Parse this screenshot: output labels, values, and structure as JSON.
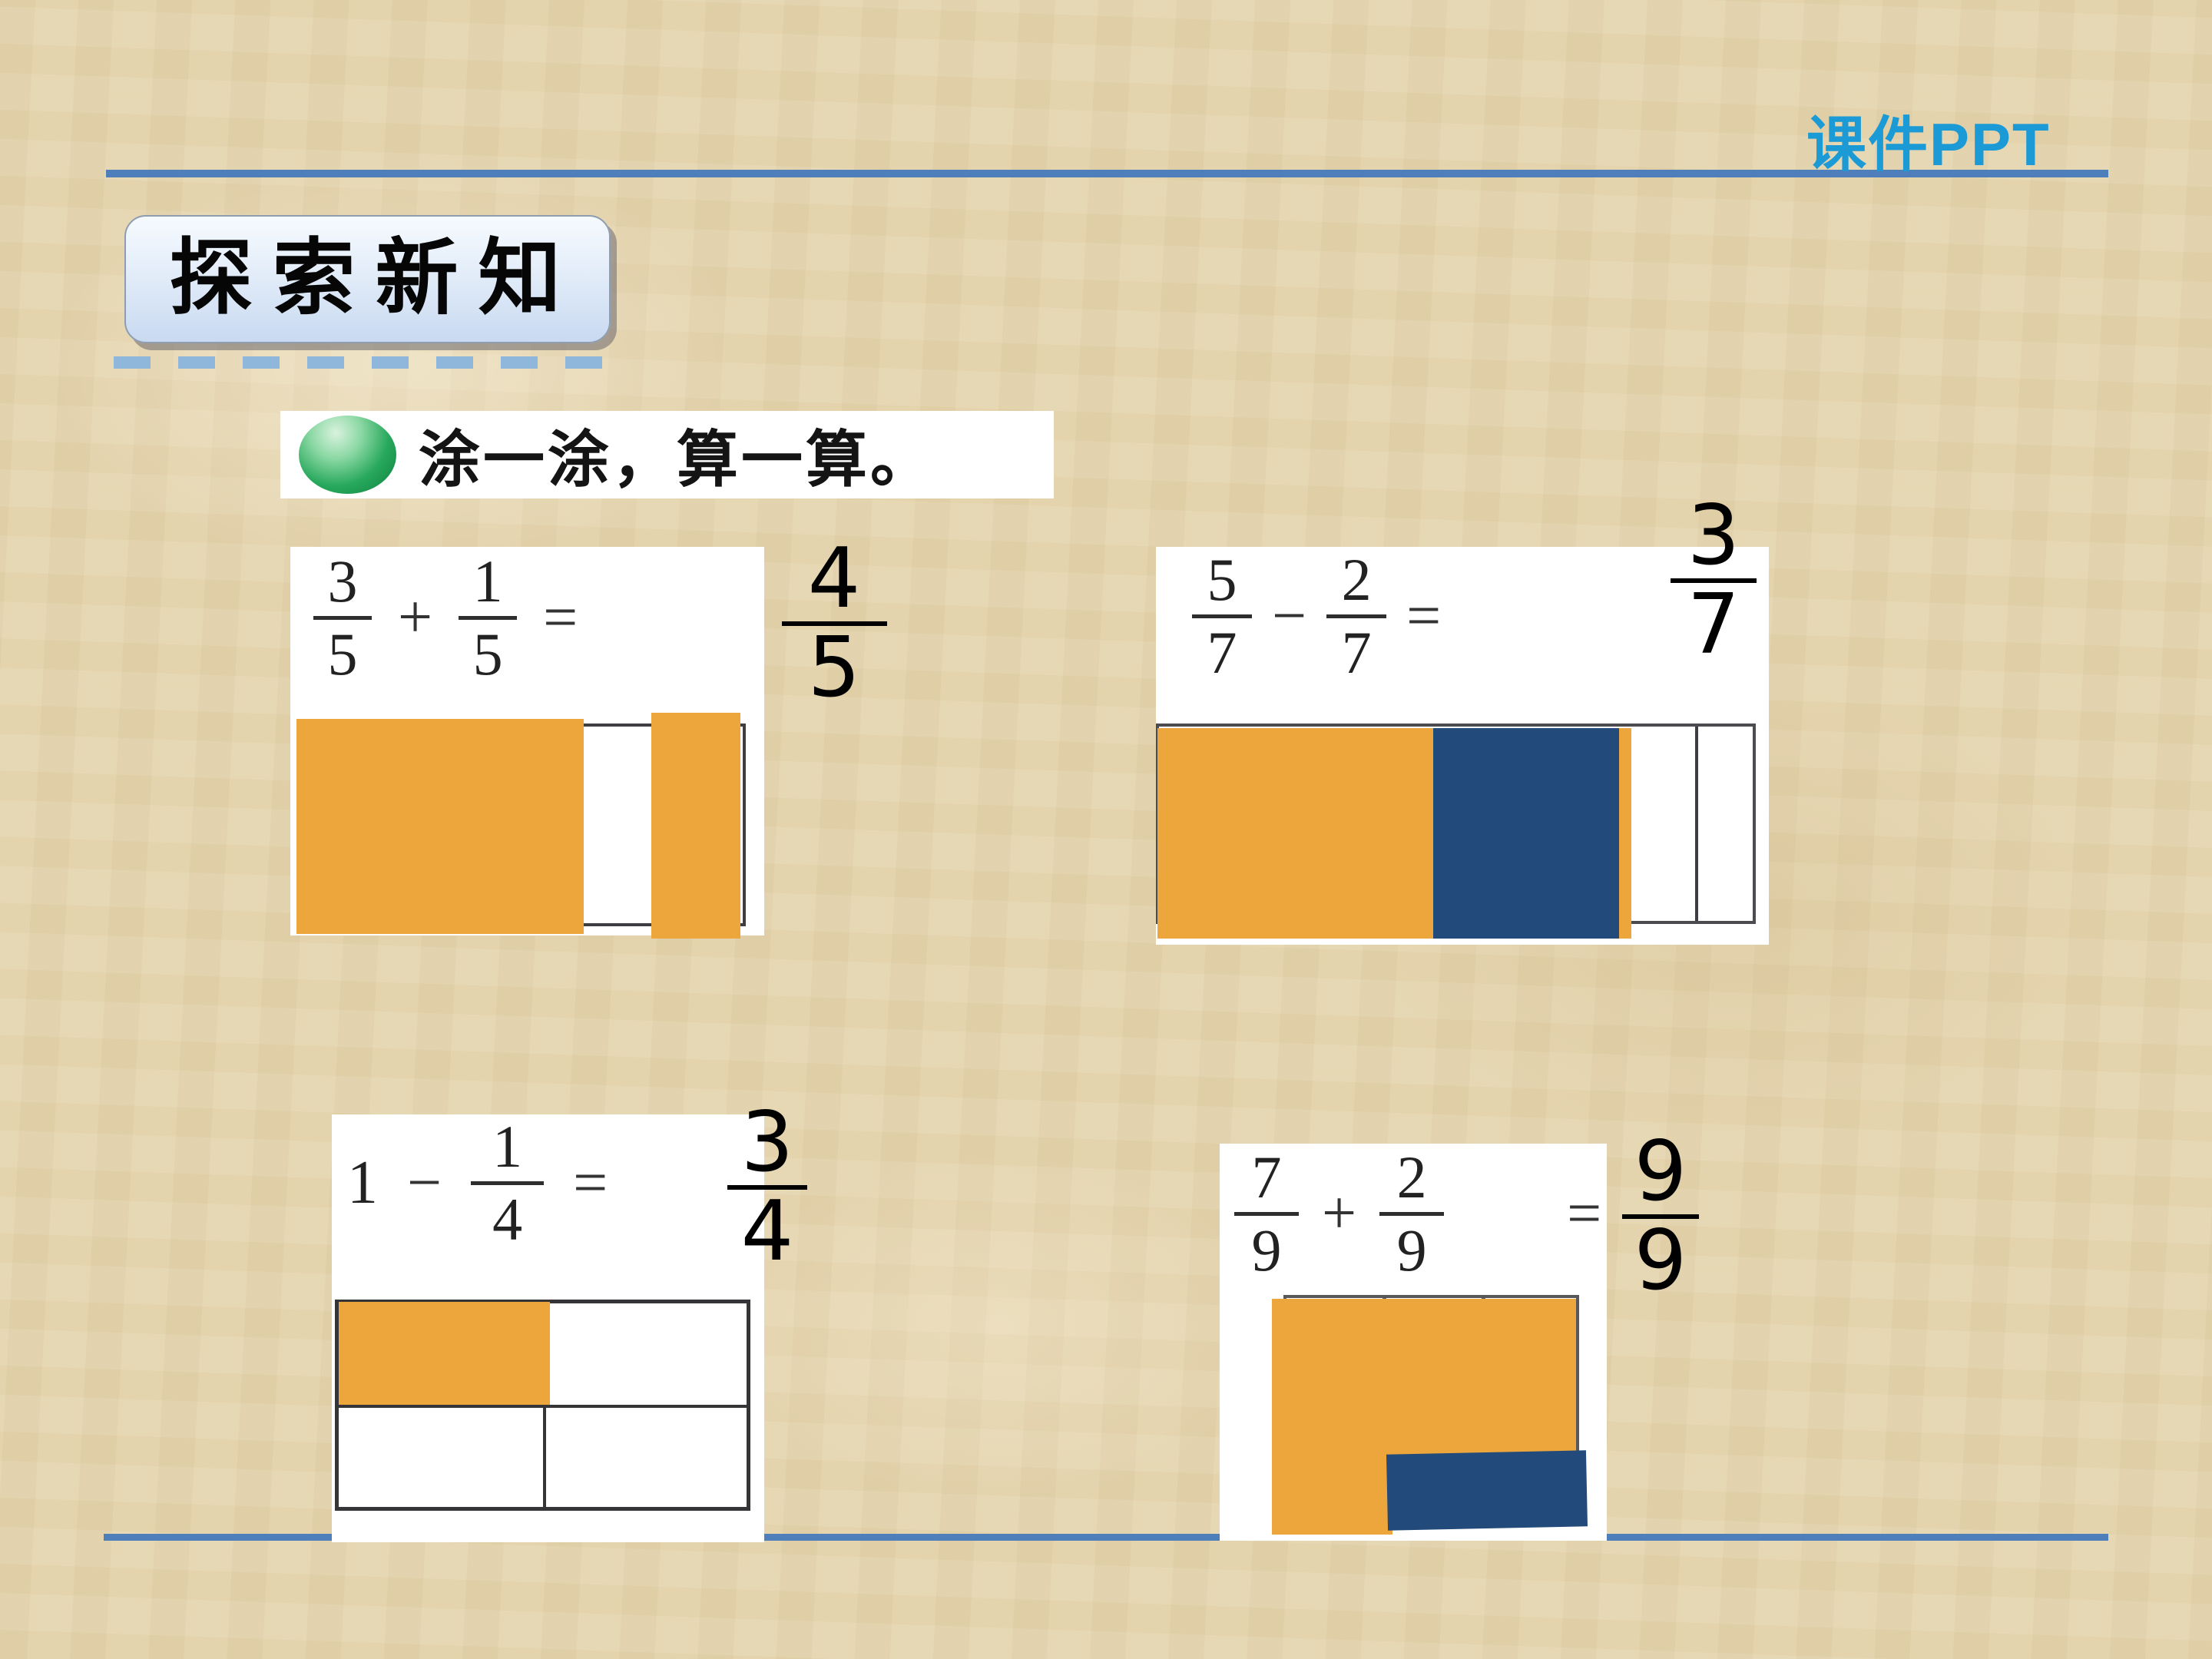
{
  "page": {
    "watermark": "课件PPT",
    "section_title": "探索新知",
    "prompt": "涂一涂，算一算。"
  },
  "colors": {
    "divider_blue": "#4E7FBB",
    "watermark_blue": "#1B9AD6",
    "dash_blue": "#8FB7DC",
    "shade_orange": "#ECA63C",
    "shade_navy": "#224A7B",
    "background_tan": "#E5D5AF",
    "title_box_gradient_top": "#F6FAFE",
    "title_box_gradient_bottom": "#C8D9F1",
    "green_oval": "#27A85C"
  },
  "problems": [
    {
      "n1": "3",
      "d1": "5",
      "op": "+",
      "n2": "1",
      "d2": "5",
      "eq": "=",
      "ans_n": "4",
      "ans_d": "5",
      "model": {
        "type": "bar",
        "parts": 5,
        "orange_parts": [
          1,
          2,
          3,
          5
        ],
        "white_parts": [
          4
        ]
      }
    },
    {
      "n1": "5",
      "d1": "7",
      "op": "−",
      "n2": "2",
      "d2": "7",
      "eq": "=",
      "ans_n": "3",
      "ans_d": "7",
      "model": {
        "type": "bar",
        "parts": 7,
        "orange_parts": [
          1,
          2,
          3
        ],
        "navy_parts": [
          4,
          5
        ],
        "white_parts": [
          6,
          7
        ]
      }
    },
    {
      "whole": "1",
      "op": "−",
      "n2": "1",
      "d2": "4",
      "eq": "=",
      "ans_n": "3",
      "ans_d": "4",
      "model": {
        "type": "grid",
        "rows": 2,
        "cols": 2,
        "orange_cells": 1,
        "white_cells": 3
      }
    },
    {
      "n1": "7",
      "d1": "9",
      "op": "+",
      "n2": "2",
      "d2": "9",
      "eq": "=",
      "ans_n": "9",
      "ans_d": "9",
      "model": {
        "type": "grid",
        "rows": 3,
        "cols": 3,
        "orange_cells": 7,
        "navy_cells": 2
      }
    }
  ]
}
